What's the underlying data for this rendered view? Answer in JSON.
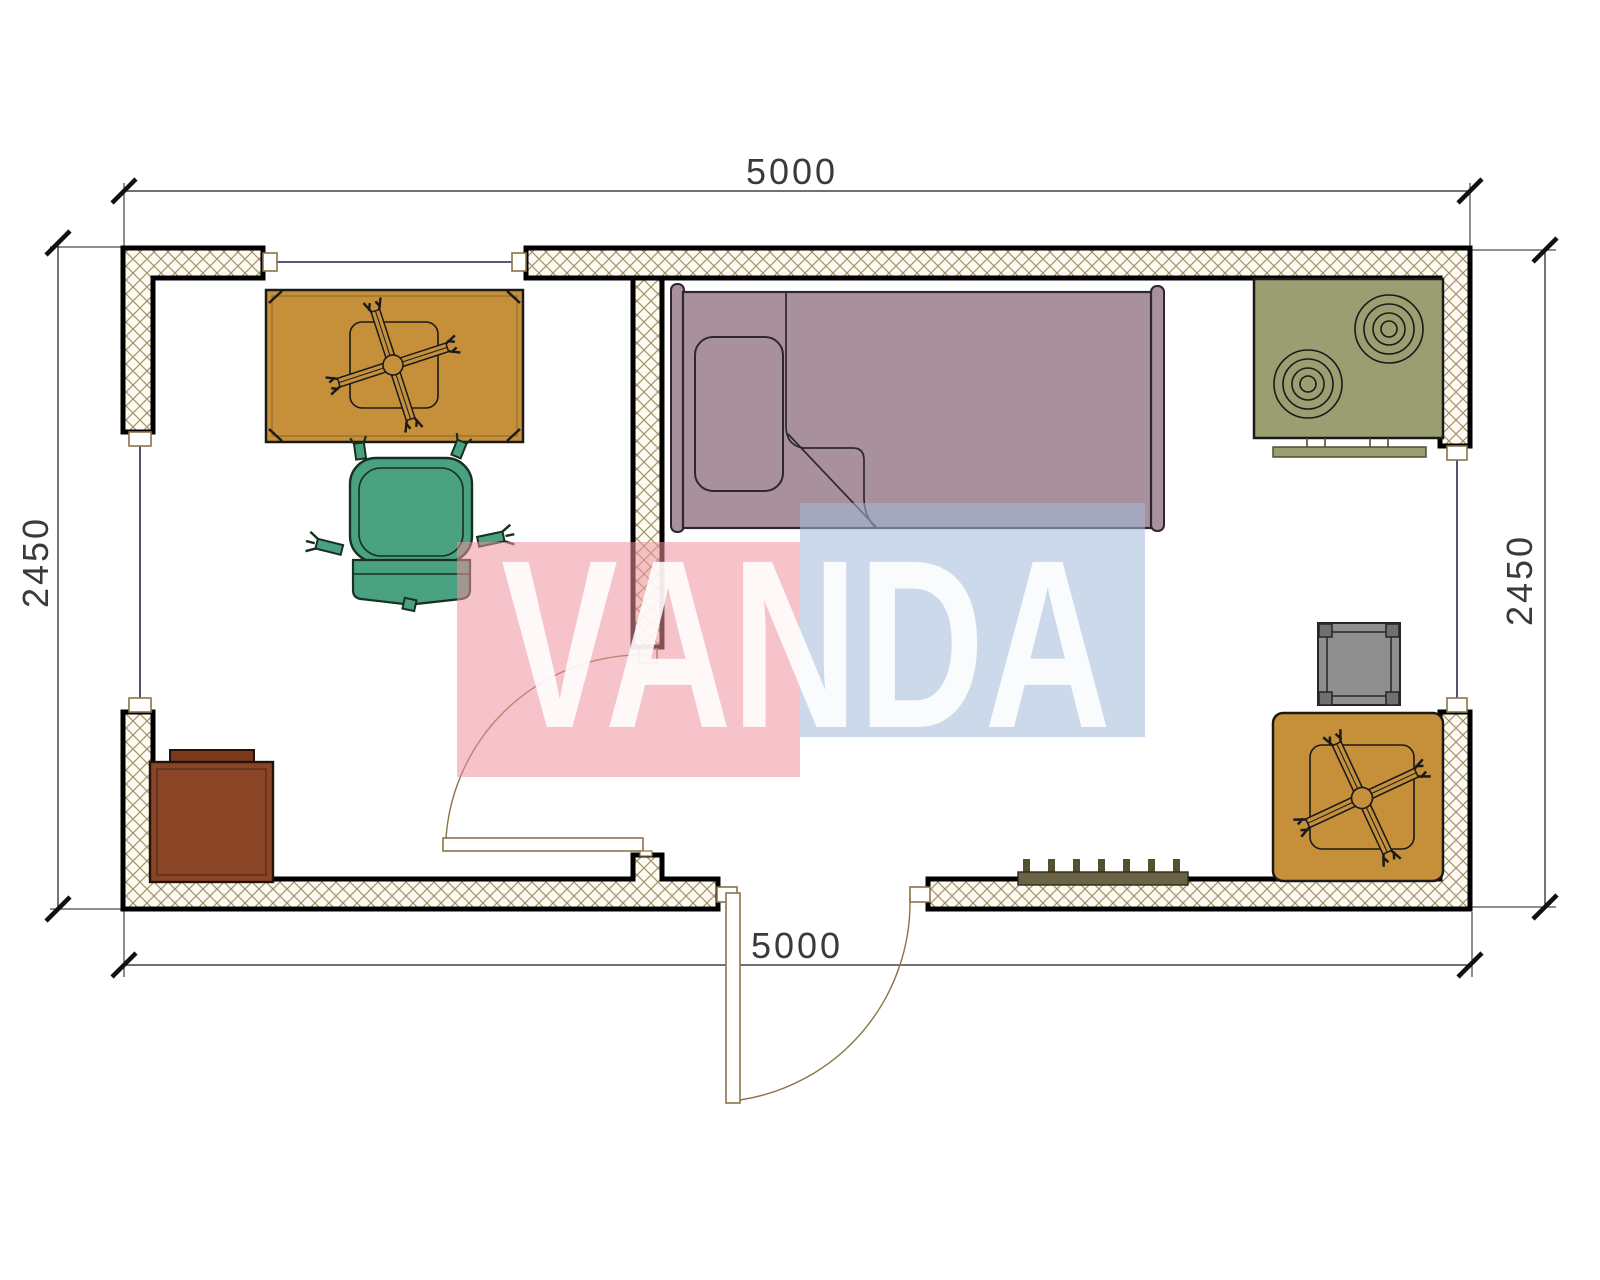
{
  "drawing": {
    "type": "architectural-floor-plan",
    "dimensions": {
      "top": "5000",
      "bottom": "5000",
      "left": "2450",
      "right": "2450"
    },
    "watermark": {
      "text": "VANDA",
      "pink_panel": "#ec929d",
      "blue_panel": "#a3bad8",
      "letter_color": "#ffffff"
    },
    "colors": {
      "wall_border": "#000000",
      "wall_hatch_line": "#a2926a",
      "wall_hatch_bg": "#fdfaf2",
      "table": "#c6903a",
      "bed": "#a8909c",
      "bed_outline": "#2e2733",
      "chair": "#4aa181",
      "stove": "#9b9e70",
      "cabinet": "#8a4527",
      "cabinet_lip": "#7a3a1e",
      "small_table": "#8f8f8f",
      "radiator": "#6b6345",
      "door_frame": "#8a7348",
      "window_line": "#3f3f66",
      "dimension_line": "#1c1c1c"
    },
    "symbols": [
      "square-table-with-fan-symbol",
      "office-chair-symbol",
      "single-bed-symbol",
      "two-burner-stove-symbol",
      "bedside-cabinet-symbol",
      "radiator-symbol",
      "small-square-table-symbol",
      "corner-table-with-fan-symbol",
      "door-swing-symbol",
      "window-symbol"
    ]
  }
}
